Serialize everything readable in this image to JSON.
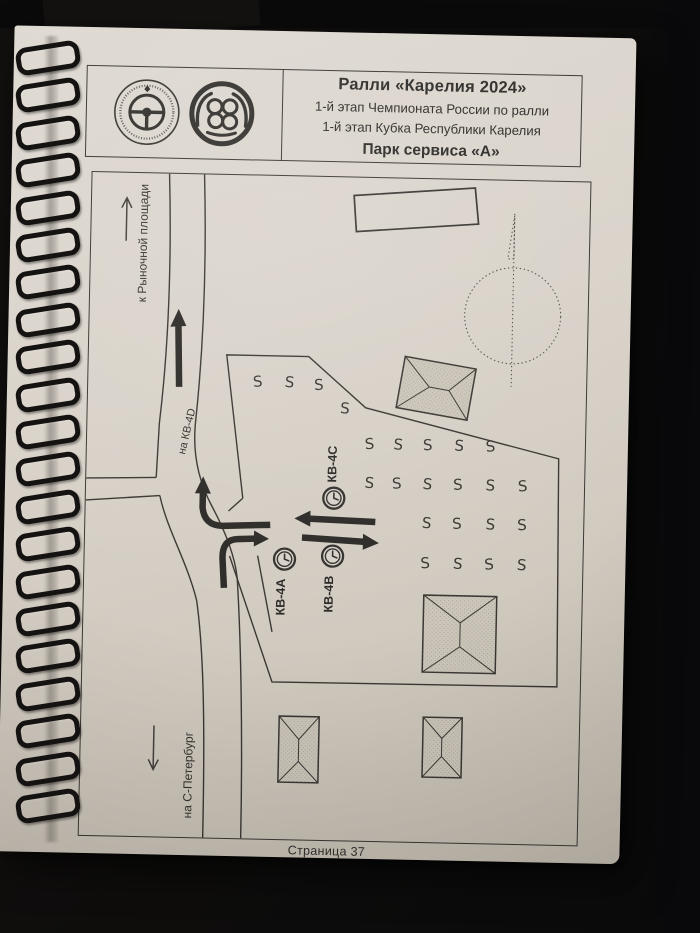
{
  "header": {
    "title": "Ралли «Карелия 2024»",
    "line2": "1-й этап Чемпионата России по ралли",
    "line3": "1-й этап Кубка Республики Карелия",
    "line4": "Парк сервиса «А»",
    "logo1": "steering-wheel-federation-emblem",
    "logo2": "wings-and-rings-club-emblem"
  },
  "map": {
    "labels": {
      "to_market_square": "к Рыночной площади",
      "to_kv_4d": "на КВ-4D",
      "to_st_petersburg": "на С-Петербург",
      "time_control_a": "КВ-4А",
      "time_control_b": "КВ-4В",
      "time_control_c": "КВ-4С"
    },
    "service_slot_symbol": "S",
    "service_slots": [
      [
        170,
        211,
        -6
      ],
      [
        201,
        211,
        4
      ],
      [
        231,
        213,
        -3
      ],
      [
        257,
        236,
        3
      ],
      [
        283,
        271,
        -5
      ],
      [
        311,
        271,
        4
      ],
      [
        341,
        271,
        -3
      ],
      [
        372,
        271,
        3
      ],
      [
        404,
        271,
        -6
      ],
      [
        283,
        310,
        4
      ],
      [
        311,
        310,
        -4
      ],
      [
        341,
        310,
        5
      ],
      [
        372,
        310,
        -3
      ],
      [
        404,
        310,
        3
      ],
      [
        437,
        310,
        -5
      ],
      [
        341,
        349,
        4
      ],
      [
        372,
        349,
        -4
      ],
      [
        405,
        349,
        3
      ],
      [
        437,
        349,
        -3
      ],
      [
        341,
        389,
        -4
      ],
      [
        373,
        389,
        4
      ],
      [
        405,
        389,
        -5
      ],
      [
        437,
        389,
        3
      ]
    ]
  },
  "footer": {
    "page_label": "Страница 37"
  },
  "colors": {
    "paper": "#d8d2c9",
    "ink": "#3b3834",
    "arrow": "#2d2b28",
    "background": "#0e0d0c"
  }
}
